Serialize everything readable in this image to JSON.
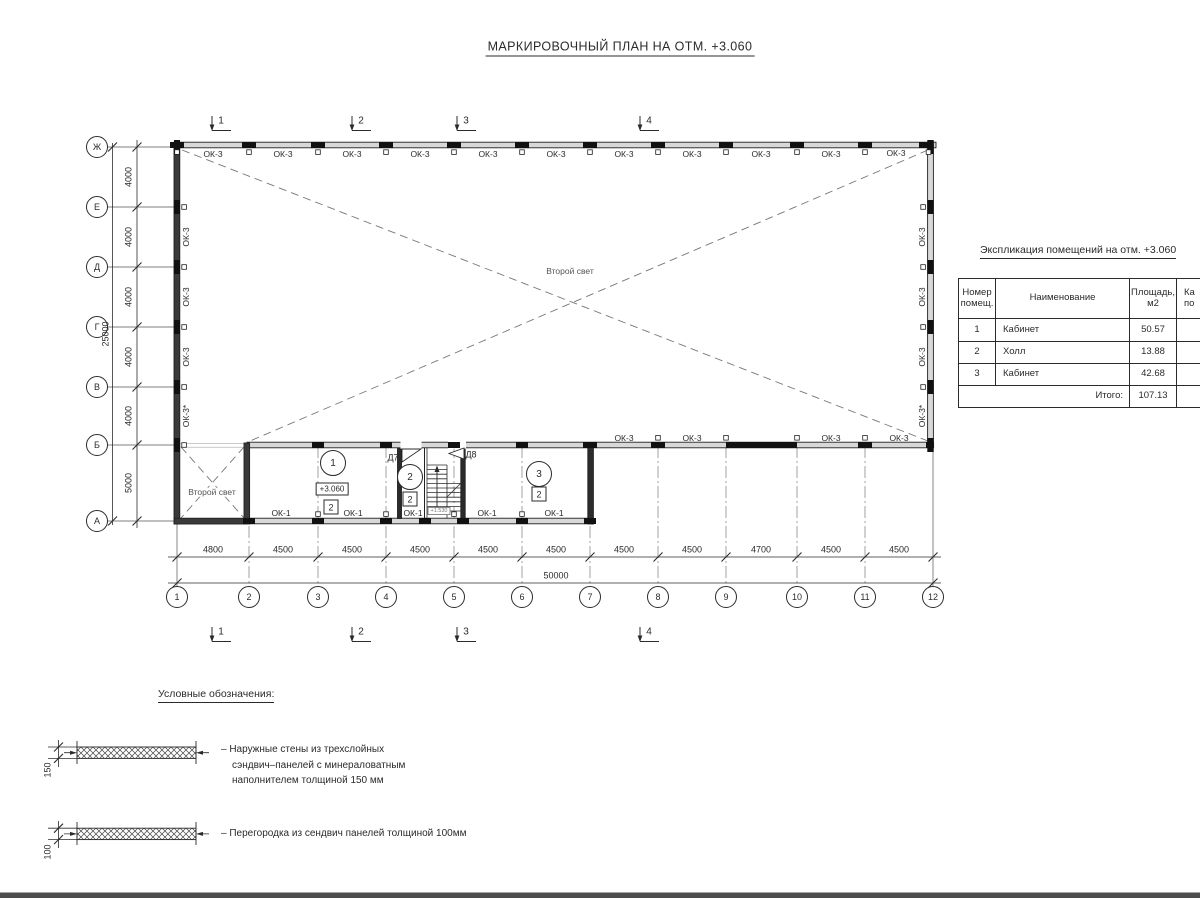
{
  "title": "МАРКИРОВОЧНЫЙ ПЛАН НА ОТМ. +3.060",
  "plan": {
    "window_exterior": "ОК-3",
    "window_exterior_star": "ОК-3*",
    "window_interior": "ОК-1",
    "second_light": "Второй свет",
    "elevation": "+3.060",
    "stair_elevation": "+1.530",
    "door_7": "Д7",
    "door_8": "Д8",
    "rooms": [
      "1",
      "2",
      "3"
    ],
    "category": "2",
    "row_axes": [
      "Ж",
      "Е",
      "Д",
      "Г",
      "В",
      "Б",
      "А"
    ],
    "col_axes": [
      "1",
      "2",
      "3",
      "4",
      "5",
      "6",
      "7",
      "8",
      "9",
      "10",
      "11",
      "12"
    ],
    "sections": [
      "1",
      "2",
      "3",
      "4"
    ]
  },
  "dims": {
    "bottom": [
      "4800",
      "4500",
      "4500",
      "4500",
      "4500",
      "4500",
      "4500",
      "4500",
      "4700",
      "4500",
      "4500"
    ],
    "bottom_total": "50000",
    "left": [
      "4000",
      "4000",
      "4000",
      "4000",
      "4000",
      "5000"
    ],
    "left_total": "25000"
  },
  "table": {
    "title": "Экспликация помещений на отм. +3.060",
    "header": {
      "c1a": "Номер",
      "c1b": "помещ.",
      "c2": "Наименование",
      "c3a": "Площадь,",
      "c3b": "м2",
      "c4a": "Ка",
      "c4b": "по"
    },
    "rows": [
      {
        "num": "1",
        "name": "Кабинет",
        "area": "50.57"
      },
      {
        "num": "2",
        "name": "Холл",
        "area": "13.88"
      },
      {
        "num": "3",
        "name": "Кабинет",
        "area": "42.68"
      }
    ],
    "total_label": "Итого:",
    "total_area": "107.13"
  },
  "legend": {
    "title": "Условные обозначения:",
    "item1": {
      "thickness": "150",
      "line1": "– Наружные стены из трехслойных",
      "line2": "сэндвич–панелей с минераловатным",
      "line3": "наполнителем толщиной 150 мм"
    },
    "item2": {
      "thickness": "100",
      "line1": "– Перегородка из сендвич панелей толщиной 100мм"
    }
  }
}
